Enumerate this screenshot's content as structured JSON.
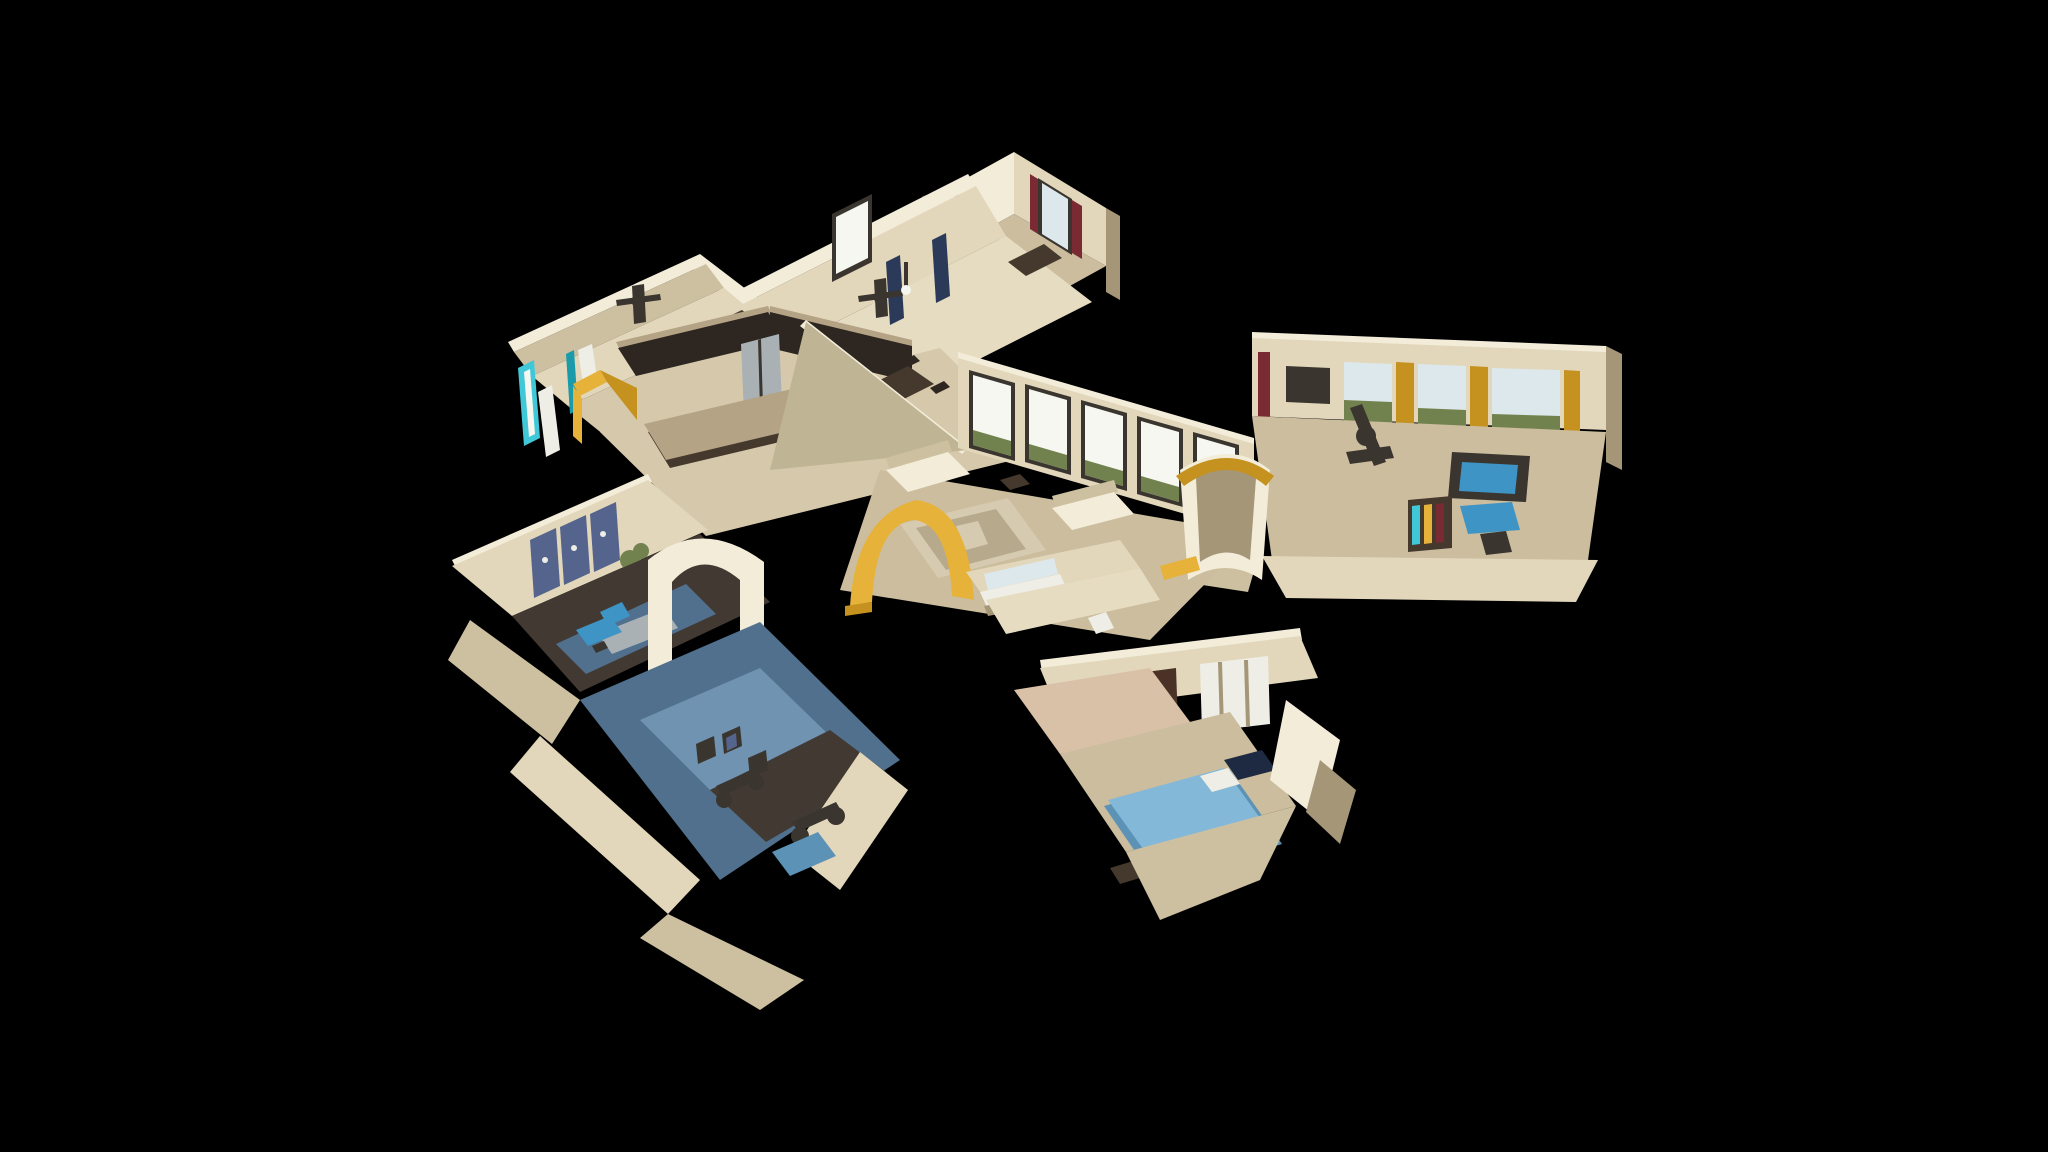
{
  "app": {
    "name": "3D Virtual Tour Viewer",
    "view_mode": "dollhouse",
    "background_color": "#000000"
  },
  "scene": {
    "description": "Overhead oblique dollhouse cutaway of a single-story residence, photogrammetry style, floating on black",
    "rooms": [
      {
        "id": "room-upper-bedroom",
        "label": "Bedroom with navy curtains and ceiling fan"
      },
      {
        "id": "room-media",
        "label": "Media room with maroon curtains and navy couch"
      },
      {
        "id": "room-left-wing",
        "label": "Utility room with teal window and white door"
      },
      {
        "id": "room-kitchen-dining",
        "label": "Kitchen with dark cabinets, stainless fridge, granite island and dining set"
      },
      {
        "id": "room-great-room",
        "label": "Great room with window wall, cream sofas, patterned rug and gold arch"
      },
      {
        "id": "room-right-wing",
        "label": "Family room with gold curtains, treadmill, blue desk and bookshelf"
      },
      {
        "id": "room-hall-bath",
        "label": "Hallway bathroom with vanity and mirror"
      },
      {
        "id": "room-master-bedroom",
        "label": "Master bedroom with blue bed and white double doors"
      },
      {
        "id": "room-office-gym",
        "label": "Office with world map art and home gym with exercise bikes"
      }
    ],
    "palette": {
      "bg": "#000000",
      "wallBright": "#f2ecd9",
      "wallLight": "#e2d7bb",
      "wallMid": "#cdc0a0",
      "wallShade": "#a69678",
      "wallDark": "#7e6f54",
      "wallKhaki": "#bfb494",
      "floorTile": "#d6c9ab",
      "floorTileLight": "#e6dcc1",
      "floorCarpet": "#cbbd9e",
      "floorSalmon": "#d9c1a8",
      "floorWoodDark": "#423a32",
      "floorGymBlue": "#50708e",
      "floorGymLight": "#6f93b1",
      "cabinetDark": "#2e2620",
      "cabinetDark2": "#45382c",
      "steel": "#a9b1b5",
      "granite": "#b5a385",
      "navy": "#2b3a58",
      "navyDark": "#1e2a42",
      "maroon": "#7a2a33",
      "teal": "#40c8d8",
      "tealDark": "#1b9aa9",
      "yellow": "#e6b23a",
      "yellowDark": "#c5911f",
      "blueBed": "#84b8d8",
      "blueBedDark": "#5c92b5",
      "blueChair": "#3f94c6",
      "windowWhite": "#f5f7f0",
      "windowBlue": "#dde8ec",
      "foliage": "#72824e",
      "fanDark": "#3a352e",
      "artNavy": "#55648c",
      "rugLight": "#d6cab0",
      "rugPattern": "#b7aa8c",
      "doorWhite": "#efeee6",
      "doorDark": "#4a3326"
    }
  }
}
